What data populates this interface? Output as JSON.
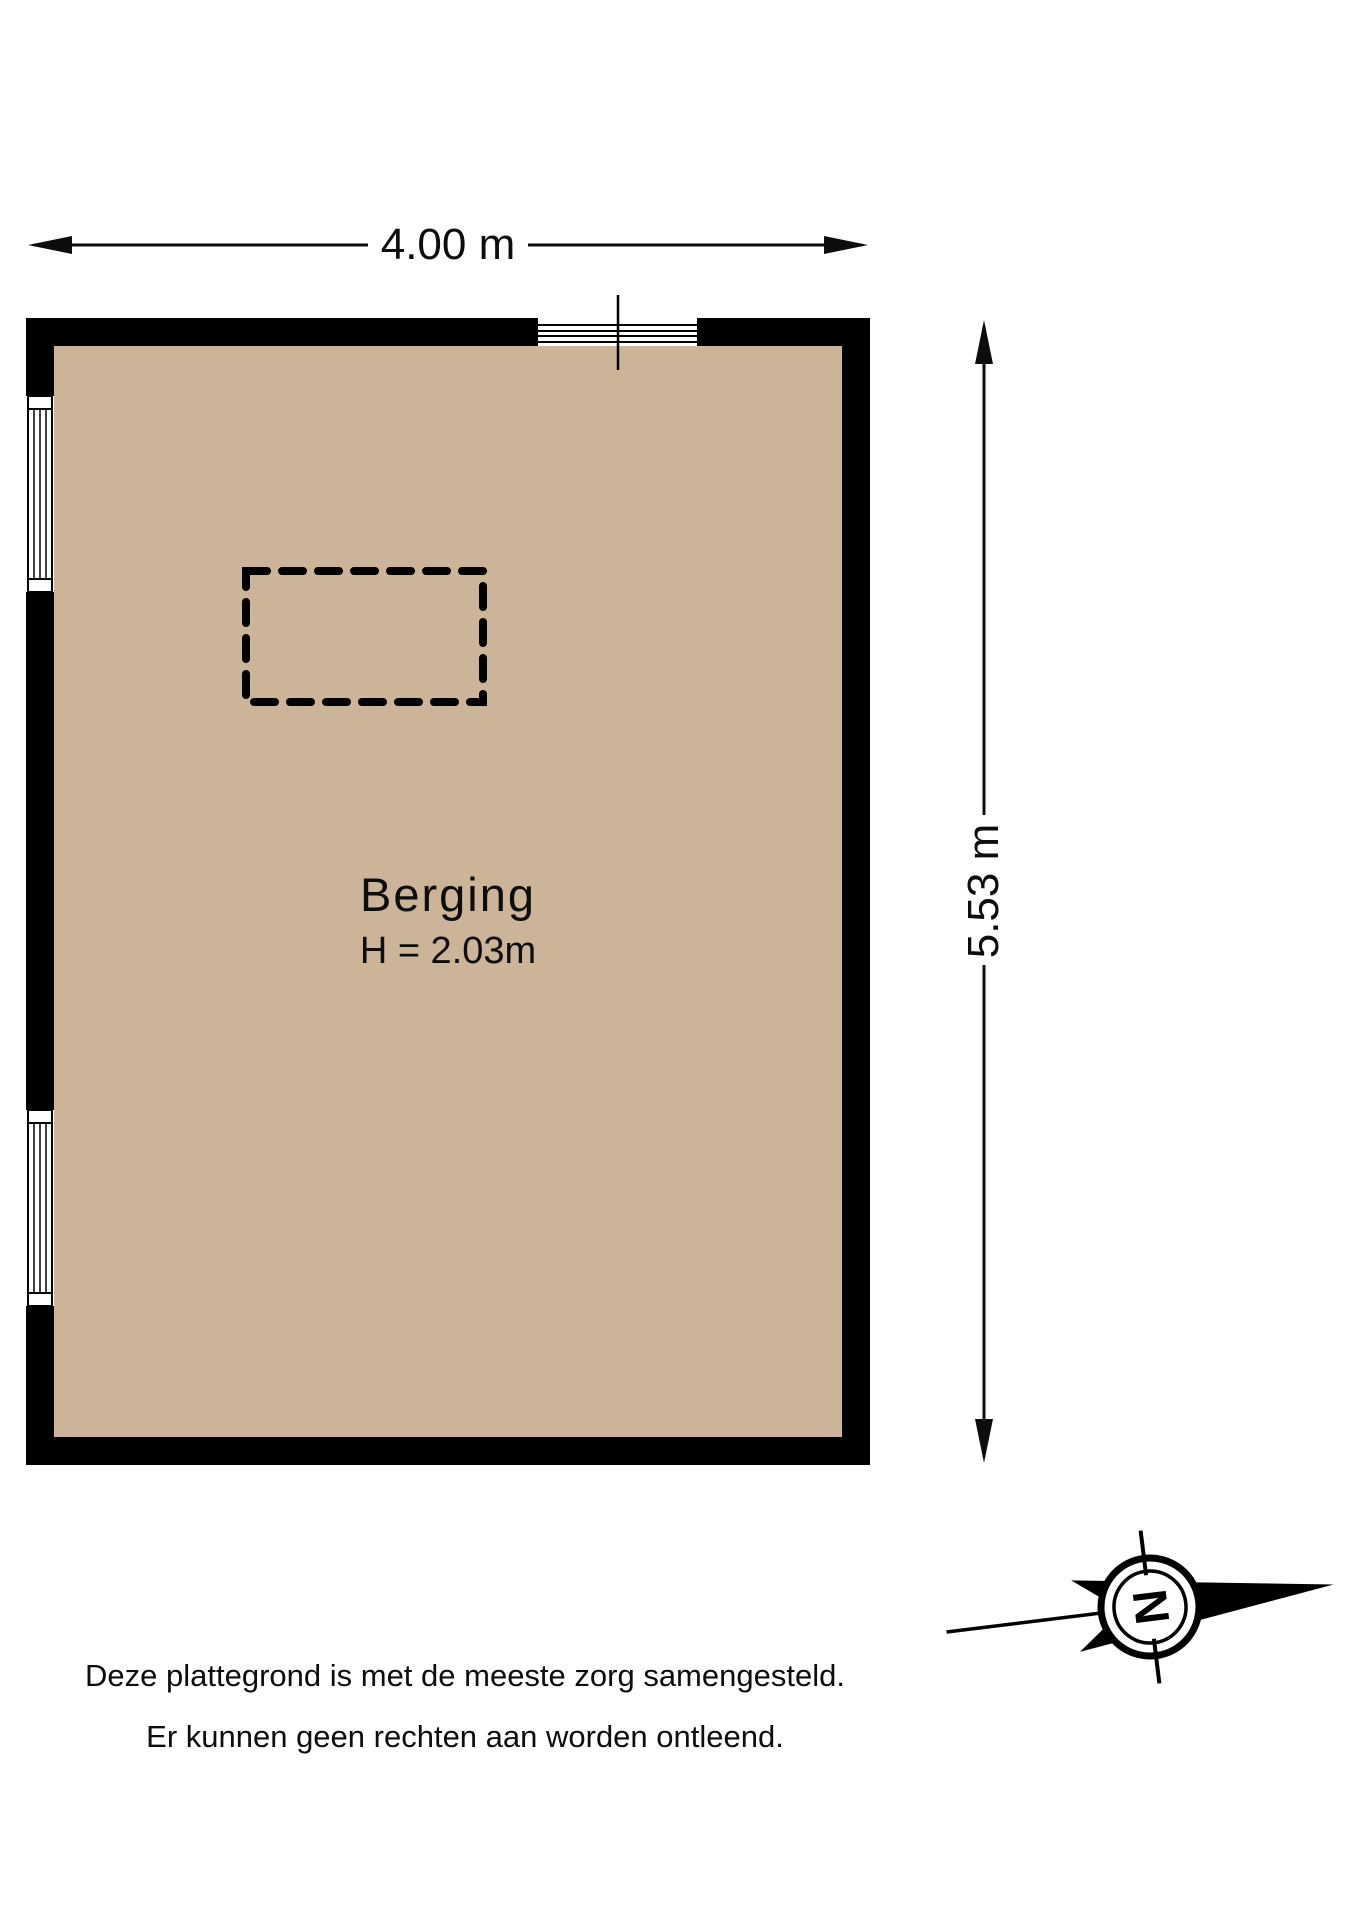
{
  "dimensions": {
    "width_label": "4.00 m",
    "height_label": "5.53 m"
  },
  "room": {
    "name": "Berging",
    "height_label": "H = 2.03m"
  },
  "compass": {
    "north_label": "N"
  },
  "disclaimer": {
    "line1": "Deze plattegrond is met de meeste zorg samengesteld.",
    "line2": "Er kunnen geen rechten aan worden ontleend."
  },
  "colors": {
    "floor": "#cbb498",
    "wall": "#000000",
    "line": "#0d0d0d"
  }
}
